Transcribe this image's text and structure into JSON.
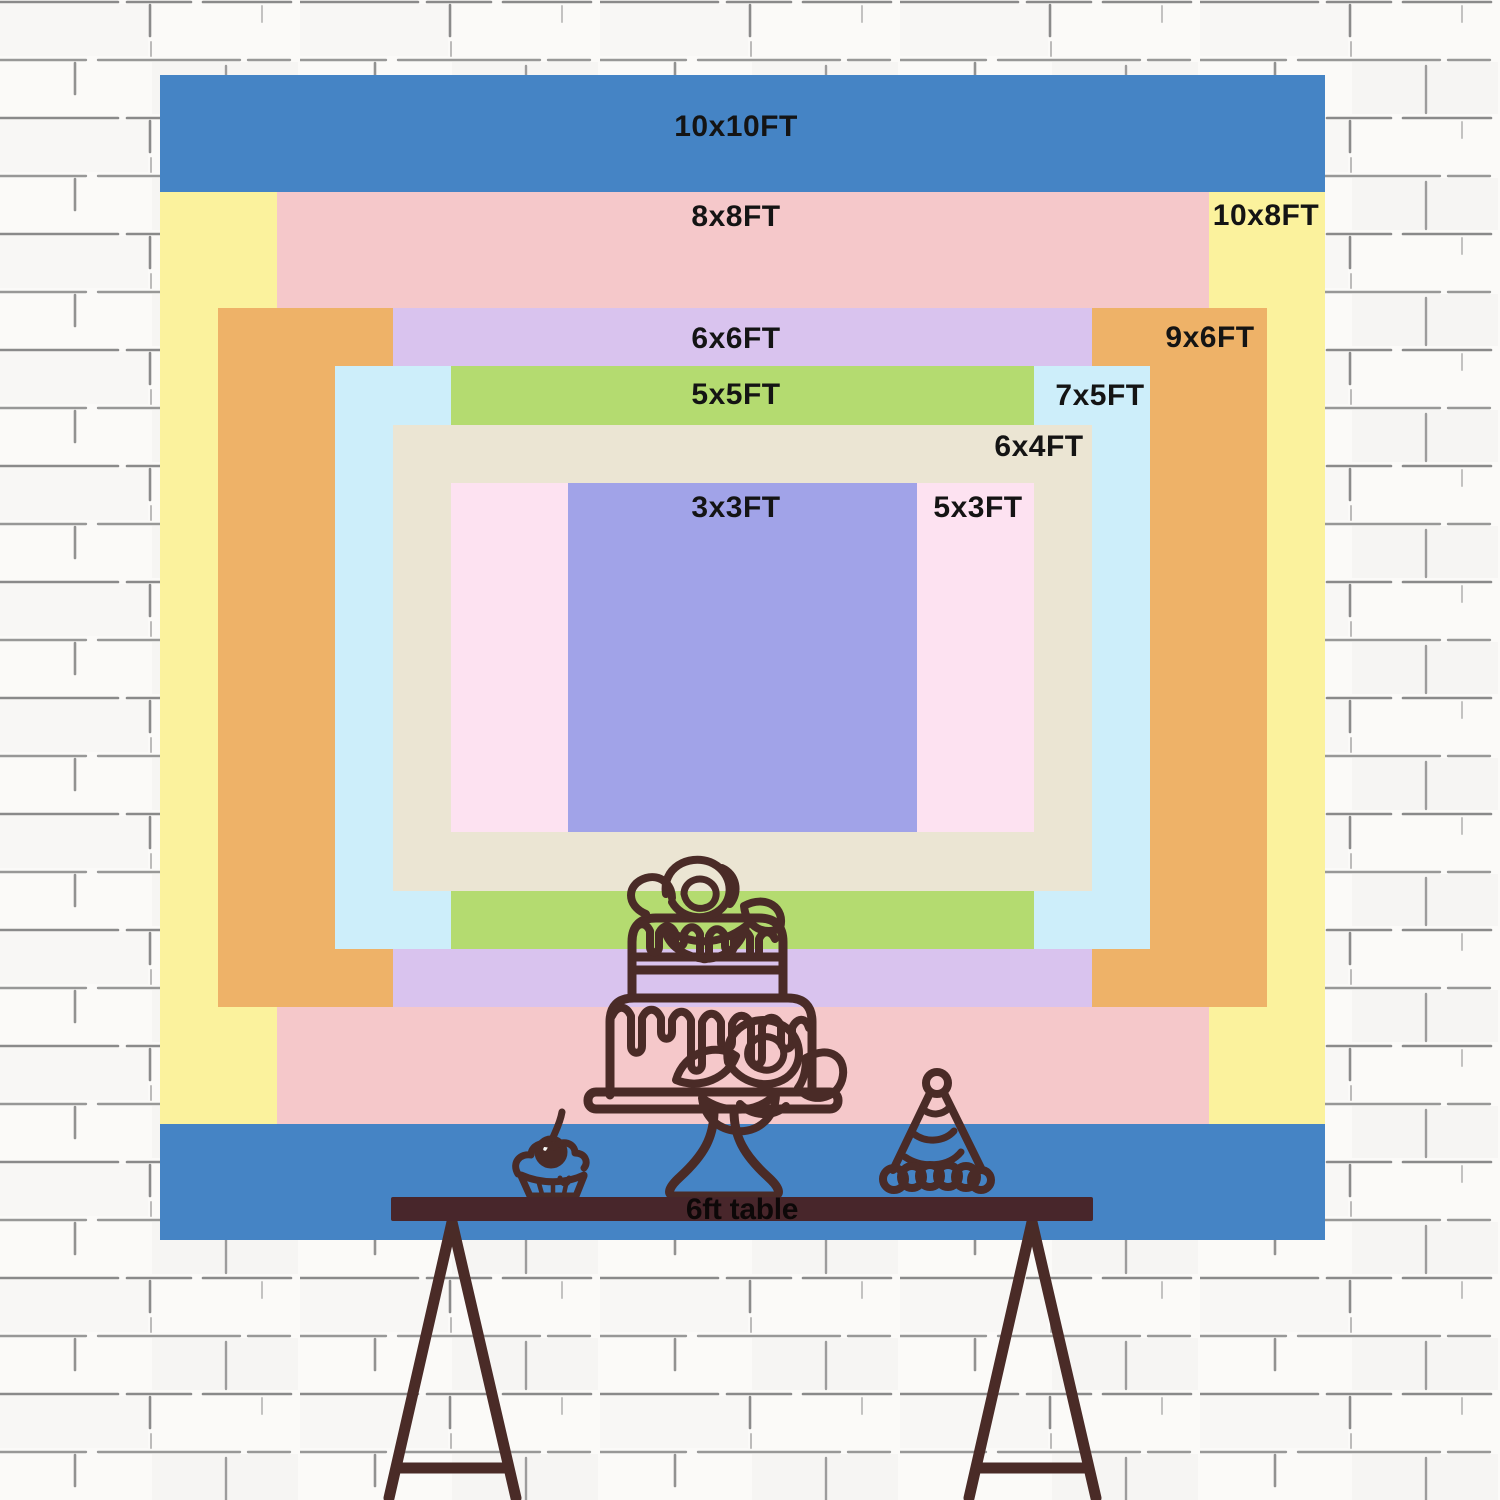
{
  "backdrop": {
    "label_color": "#141414",
    "sizes": [
      {
        "id": "10x10",
        "label": "10x10FT",
        "width_ft": 10,
        "height_ft": 10,
        "color": "#4584c5"
      },
      {
        "id": "10x8",
        "label": "10x8FT",
        "width_ft": 10,
        "height_ft": 8,
        "color": "#fbf29d"
      },
      {
        "id": "8x8",
        "label": "8x8FT",
        "width_ft": 8,
        "height_ft": 8,
        "color": "#f5c8ca"
      },
      {
        "id": "9x6",
        "label": "9x6FT",
        "width_ft": 9,
        "height_ft": 6,
        "color": "#eeb268"
      },
      {
        "id": "6x6",
        "label": "6x6FT",
        "width_ft": 6,
        "height_ft": 6,
        "color": "#d9c3ee"
      },
      {
        "id": "7x5",
        "label": "7x5FT",
        "width_ft": 7,
        "height_ft": 5,
        "color": "#cdeefa"
      },
      {
        "id": "5x5",
        "label": "5x5FT",
        "width_ft": 5,
        "height_ft": 5,
        "color": "#b4db70"
      },
      {
        "id": "6x4",
        "label": "6x4FT",
        "width_ft": 6,
        "height_ft": 4,
        "color": "#ebe5d3"
      },
      {
        "id": "5x3",
        "label": "5x3FT",
        "width_ft": 5,
        "height_ft": 3,
        "color": "#fde2f1"
      },
      {
        "id": "3x3",
        "label": "3x3FT",
        "width_ft": 3,
        "height_ft": 3,
        "color": "#a1a3e8"
      }
    ]
  },
  "table": {
    "label": "6ft table",
    "color": "#48262b",
    "text_color": "#0d0808"
  },
  "illustrations": {
    "line_color": "#4a2b27",
    "cake": "two-tier drip cake with roses on a pedestal stand",
    "cupcake": "cupcake with cherry",
    "party_hat": "striped party hat with pom-pom and scalloped trim"
  },
  "wall": {
    "background": "#fbfaf8",
    "brick_line_color": "#6e6e6e"
  }
}
